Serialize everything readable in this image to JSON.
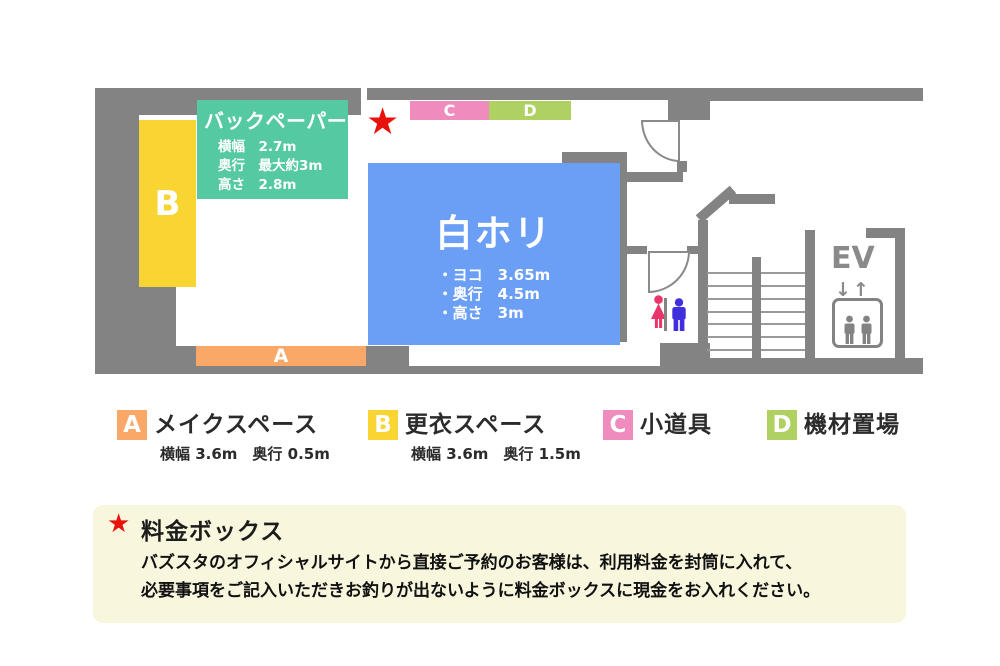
{
  "colors": {
    "wall": "#838383",
    "step": "#9a9a9a",
    "area_a": "#f9a868",
    "area_b": "#f8d532",
    "area_c": "#f08bbe",
    "area_d": "#afd161",
    "backpaper": "#55c9a2",
    "cyclorama": "#6b9ef5",
    "star_red": "#e8110c",
    "woman_pink": "#e8356a",
    "man_blue": "#3f2fdd",
    "infobox_bg": "#f8f7de"
  },
  "plan": {
    "area_a_label": "A",
    "area_b_label": "B",
    "area_c_label": "C",
    "area_d_label": "D",
    "backpaper": {
      "title": "バックペーパー",
      "lines": [
        "横幅　2.7m",
        "奥行　最大約3m",
        "高さ　2.8m"
      ]
    },
    "cyclorama": {
      "title": "白ホリ",
      "lines": [
        "・ヨコ　3.65m",
        "・奥行　4.5m",
        "・高さ　3m"
      ]
    },
    "star": "★",
    "ev_label": "EV",
    "ev_arrows": "↓↑"
  },
  "legend": {
    "items": [
      {
        "letter": "A",
        "label": "メイクスペース",
        "sub": "横幅 3.6m　奥行 0.5m"
      },
      {
        "letter": "B",
        "label": "更衣スペース",
        "sub": "横幅 3.6m　奥行 1.5m"
      },
      {
        "letter": "C",
        "label": "小道具",
        "sub": ""
      },
      {
        "letter": "D",
        "label": "機材置場",
        "sub": ""
      }
    ]
  },
  "infobox": {
    "star": "★",
    "title": "料金ボックス",
    "lines": [
      "バズスタのオフィシャルサイトから直接ご予約のお客様は、利用料金を封筒に入れて、",
      "必要事項をご記入いただきお釣りが出ないように料金ボックスに現金をお入れください。"
    ]
  }
}
